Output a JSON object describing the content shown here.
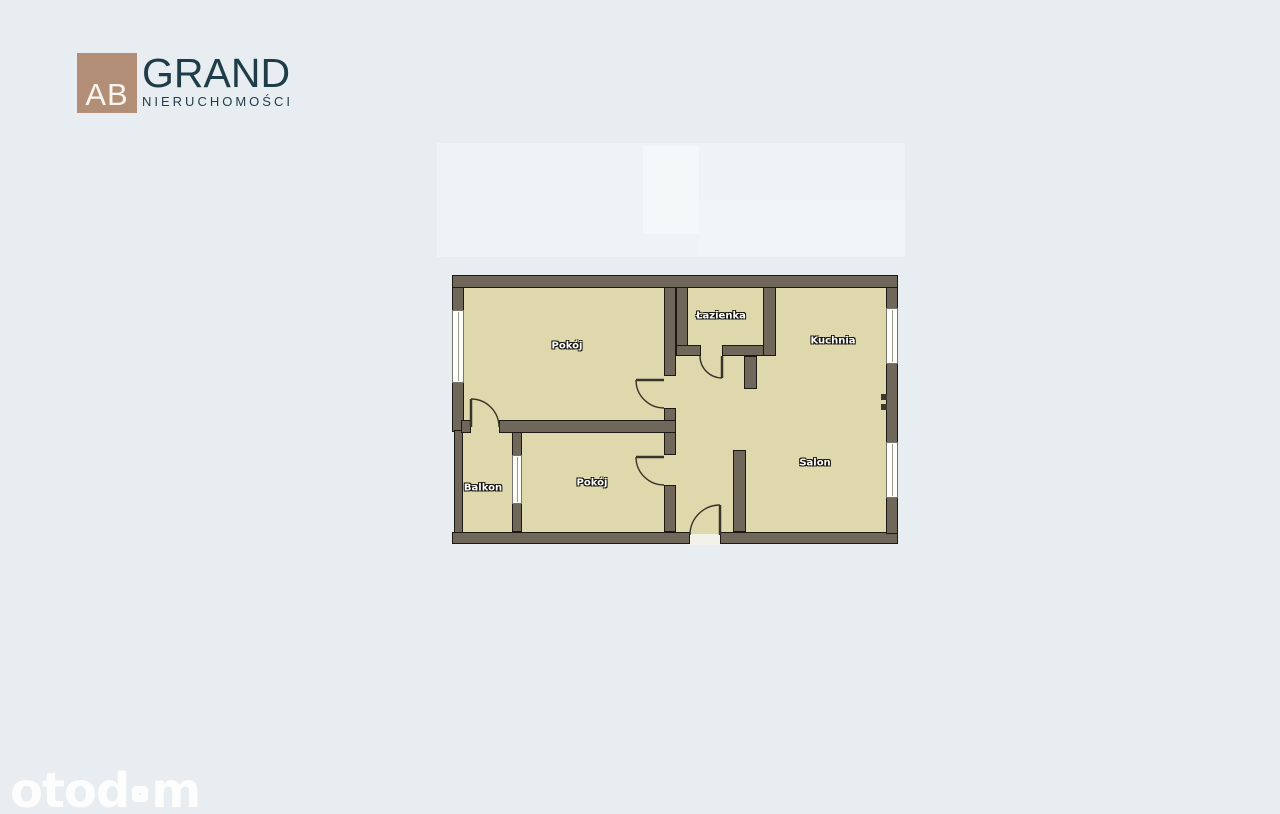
{
  "colors": {
    "background": "#e7edf0",
    "floor": "#ded8ac",
    "wall": "#6f675a",
    "wall-outline": "#1d1a15",
    "logo-square": "#b28e76",
    "brand-text": "#1f3d49",
    "watermark": "#ffffff"
  },
  "header": {
    "logo_square_text": "AB",
    "brand_name": "GRAND",
    "brand_subtitle": "NIERUCHOMOŚCI"
  },
  "floorplan": {
    "rooms": [
      {
        "name": "pokoj-1",
        "label": "Pokój"
      },
      {
        "name": "lazienka",
        "label": "Łazienka"
      },
      {
        "name": "kuchnia",
        "label": "Kuchnia"
      },
      {
        "name": "salon",
        "label": "Salon"
      },
      {
        "name": "pokoj-2",
        "label": "Pokój"
      },
      {
        "name": "balkon",
        "label": "Balkon"
      }
    ]
  },
  "watermark": {
    "brand": "otodom",
    "part1": "otod",
    "part2": "m"
  }
}
